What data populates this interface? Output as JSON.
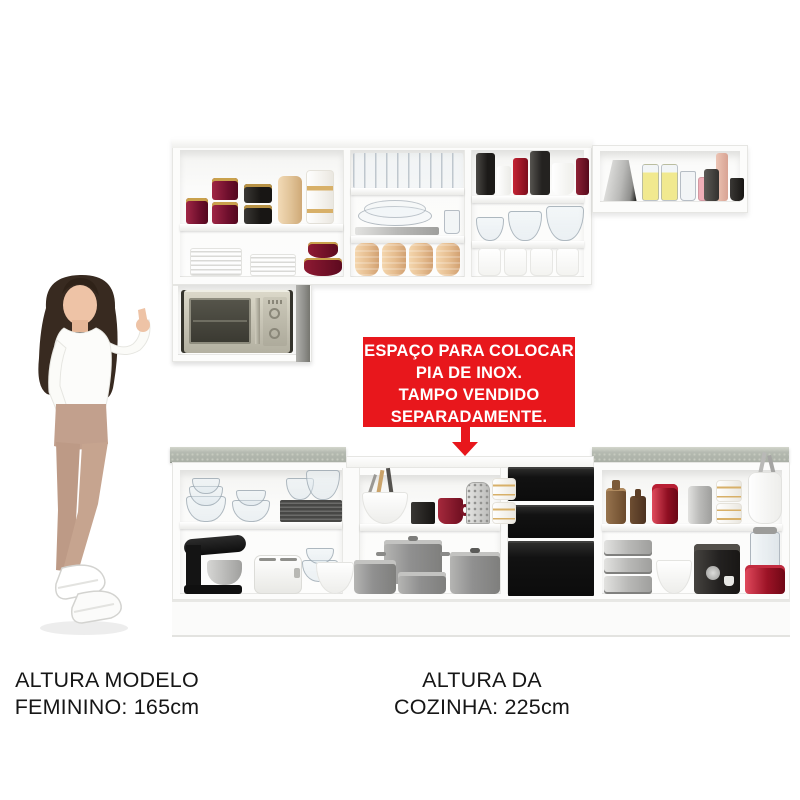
{
  "banner": {
    "lines": [
      "ESPAÇO PARA COLOCAR",
      "PIA DE INOX.",
      "TAMPO VENDIDO",
      "SEPARADAMENTE."
    ],
    "bg_color": "#e8171c",
    "text_color": "#ffffff"
  },
  "arrow": {
    "direction": "down",
    "color": "#e8171c"
  },
  "captions": {
    "model": {
      "line1": "ALTURA MODELO",
      "line2": "FEMININO: 165cm"
    },
    "kitchen": {
      "line1": "ALTURA DA",
      "line2": "COZINHA: 225cm"
    }
  },
  "colors": {
    "background": "#ffffff",
    "cabinet_white": "#fcfcfb",
    "countertop_gray": "#b5bab1",
    "drawer_black": "#121212",
    "banner_red": "#e8171c"
  },
  "scene": {
    "model": {
      "pose": "female-model-pointing-at-kitchen",
      "height": "165cm"
    },
    "kitchen_height": "225cm",
    "upper_cabinets": {
      "left_section": {
        "top_shelf": [
          "maroon-canister",
          "maroon-canister-stack",
          "black-canister-stack",
          "tan-canister",
          "white-gold-canister"
        ],
        "bottom_shelf": [
          "white-plate-stack",
          "white-plate-stack",
          "red-bowl-set"
        ]
      },
      "middle_section": {
        "top_shelf": [
          "drinking-glasses-row"
        ],
        "middle_shelf": [
          "glass-plates-on-tray",
          "small-glass"
        ],
        "bottom_shelf": [
          "tan-jar",
          "tan-jar",
          "tan-jar",
          "tan-jar"
        ]
      },
      "third_section": {
        "top_shelf": [
          "black-canister",
          "white-canister",
          "red-canister",
          "dark-canister",
          "white-mug",
          "maroon-canister"
        ],
        "middle_shelf": [
          "glass-bowl-small",
          "glass-bowl-medium",
          "glass-bowl-large"
        ],
        "bottom_shelf": [
          "white-container",
          "white-container",
          "white-container",
          "white-container"
        ]
      },
      "right_wall_cabinet": [
        "silver-kettle",
        "yellow-filled-jar",
        "yellow-filled-jar",
        "glass-jar",
        "pink-jar",
        "pink-candle",
        "gray-cup",
        "black-cup"
      ]
    },
    "microwave_niche": [
      "silver-microwave"
    ],
    "lower_cabinets": {
      "left_section": {
        "top_shelf": [
          "glass-bowl-stack",
          "glass-bowl-stack",
          "dark-plate-stack-with-glass-bowls"
        ],
        "bottom_shelf": [
          "black-stand-mixer",
          "white-toaster",
          "glass-bowl-stack",
          "white-bowl"
        ]
      },
      "sink_section": {
        "note": "open space for stainless sink, countertop sold separately",
        "top_shelf": [
          "white-bowl-with-utensils",
          "black-mug",
          "red-mug",
          "metal-grater",
          "white-gold-jar-stack"
        ],
        "bottom_shelf": [
          "gray-pot-set"
        ]
      },
      "drawers": 3,
      "right_section": {
        "top_shelf": [
          "amber-bottle",
          "amber-bottle",
          "red-canister",
          "silver-canister",
          "white-gold-jar-stack",
          "white-pitcher-with-utensils"
        ],
        "bottom_shelf": [
          "silver-tin-stack",
          "white-bowl",
          "black-coffee-machine",
          "red-blender"
        ]
      }
    }
  }
}
